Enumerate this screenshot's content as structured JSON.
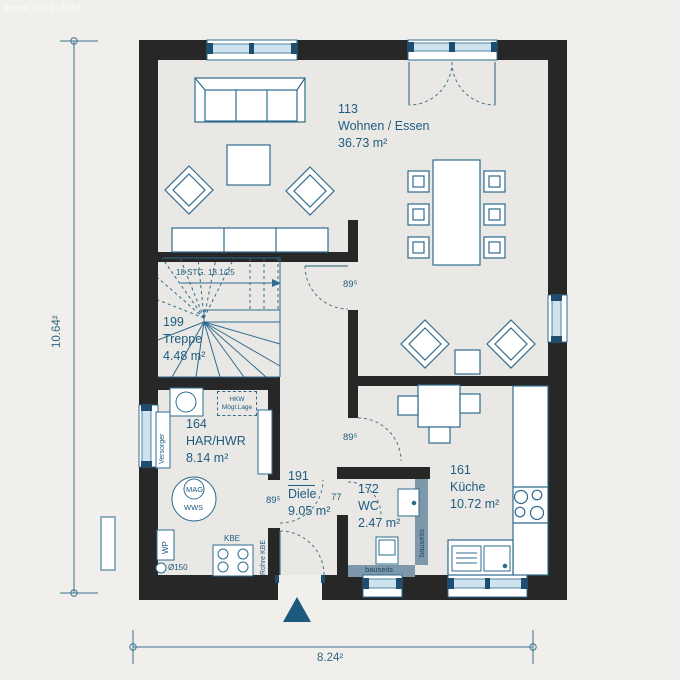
{
  "watermark": "www.allkauf.de",
  "rooms": {
    "wohnen": {
      "number": "113",
      "name": "Wohnen / Essen",
      "area": "36.73 m²"
    },
    "treppe": {
      "number": "199",
      "name": "Treppe",
      "area": "4.48 m²"
    },
    "har": {
      "number": "164",
      "name": "HAR/HWR",
      "area": "8.14 m²"
    },
    "diele": {
      "number": "191",
      "name": "Diele",
      "area": "9.05 m²"
    },
    "wc": {
      "number": "172",
      "name": "WC",
      "area": "2.47 m²"
    },
    "kueche": {
      "number": "161",
      "name": "Küche",
      "area": "10.72 m²"
    }
  },
  "stairs": {
    "label": "18 STG. 18.1/25"
  },
  "doors": {
    "essen_hall": "89⁵",
    "har": "89⁵",
    "kueche": "89⁵",
    "wc": "77"
  },
  "equipment": {
    "versorger": "Versorger",
    "wp": "WP",
    "mag": "MAG",
    "wws": "WWS",
    "kbe": "KBE",
    "rohre_kbe": "Rohre KBE",
    "durchmesser": "Ø150",
    "hkw_line1": "HKW",
    "hkw_line2": "Mögl.Lage"
  },
  "walls": {
    "bauseits": "bauseits"
  },
  "dimensions": {
    "width": "8.24²",
    "height": "10.64²"
  },
  "colors": {
    "wall": "#272727",
    "line_blue": "#2e6b8e",
    "text_blue": "#1d5c80",
    "bauseits_band": "#7d97ab",
    "glass": "#cfe3ee",
    "frame_tick": "#1d4e72",
    "floor": "#eae8e4",
    "background": "#f0efec",
    "entrance_marker": "#1c5a7d"
  }
}
